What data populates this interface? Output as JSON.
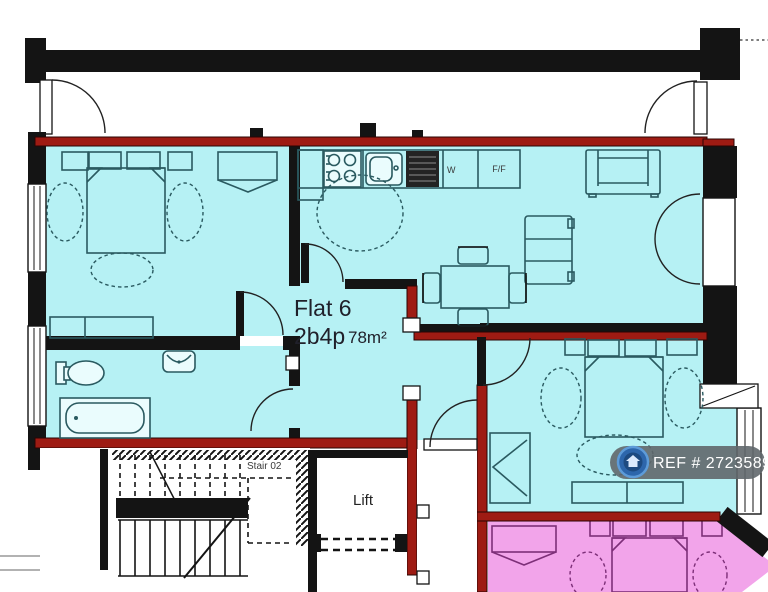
{
  "plan": {
    "flat_label": "Flat 6",
    "flat_spec": "2b4p",
    "flat_area": "78m²",
    "stair_label": "Stair 02",
    "lift_label": "Lift",
    "fridge_freezer_label": "F/F",
    "washer_label": "W"
  },
  "badge": {
    "ref_text": "REF # 2723589",
    "icon": "house-icon"
  },
  "colors": {
    "flat_fill": "#b6f1f4",
    "adjacent_flat_fill": "#f2a4ea",
    "party_wall_red": "#9e1b13",
    "wall_black": "#141414",
    "furniture_stroke": "#2a5a60",
    "badge_bg": "#60676c",
    "badge_blue": "#2d66ab",
    "badge_ring": "#5d9bd8",
    "badge_text": "#ffffff"
  }
}
